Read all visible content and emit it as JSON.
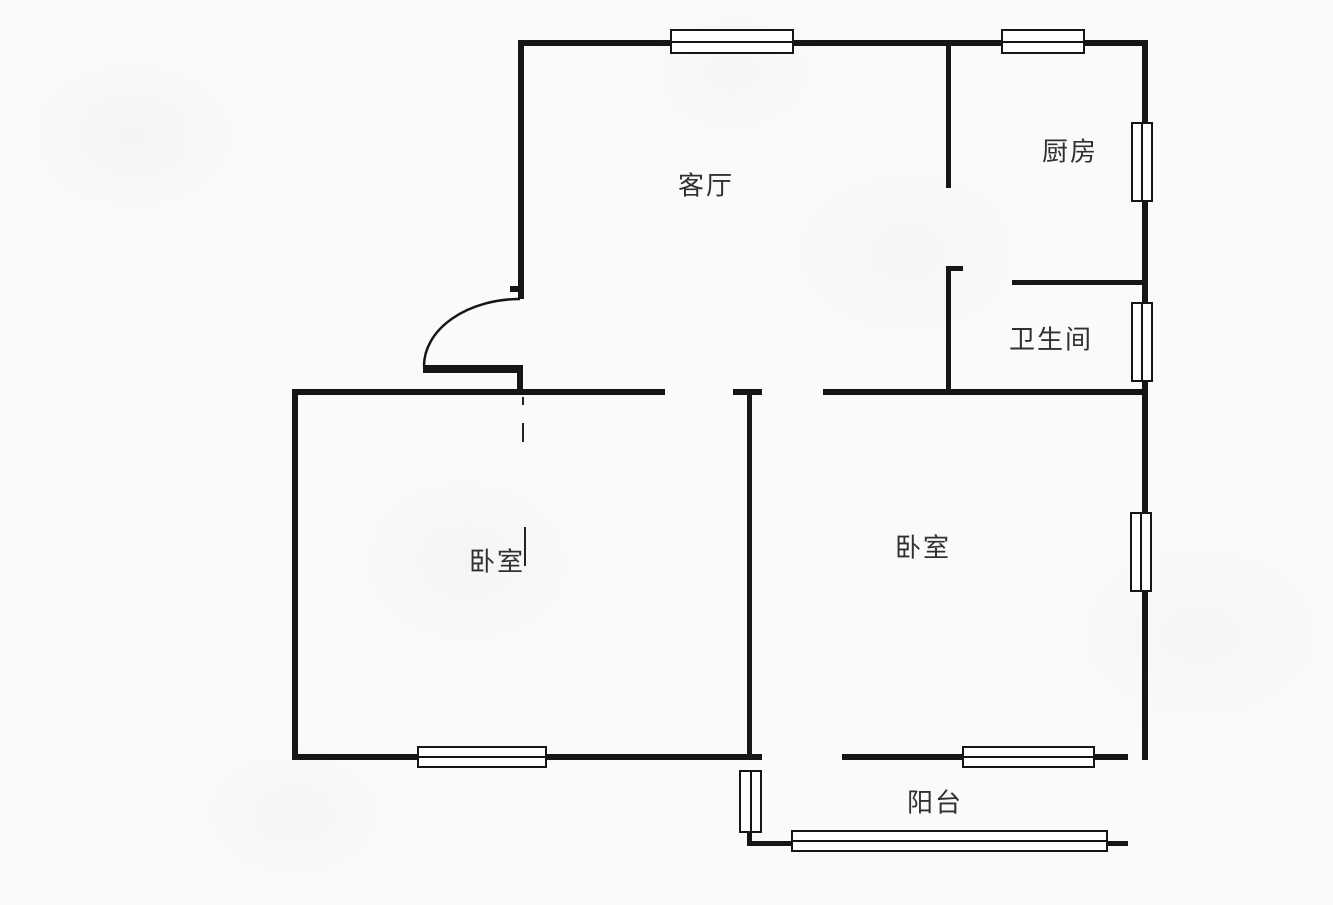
{
  "plan": {
    "colors": {
      "background": "#fbfafa",
      "line": "#161616",
      "text": "#303030"
    },
    "rooms": [
      {
        "label": "客厅",
        "x": 706,
        "y": 184
      },
      {
        "label": "厨房",
        "x": 1070,
        "y": 150
      },
      {
        "label": "卫生间",
        "x": 1051,
        "y": 338
      },
      {
        "label": "卧室",
        "x": 497,
        "y": 560
      },
      {
        "label": "卧室",
        "x": 923,
        "y": 546
      },
      {
        "label": "阳台",
        "x": 935,
        "y": 801
      }
    ],
    "walls": [
      {
        "x": 518,
        "y": 40,
        "w": 153,
        "h": 6
      },
      {
        "x": 793,
        "y": 40,
        "w": 209,
        "h": 6
      },
      {
        "x": 1084,
        "y": 40,
        "w": 64,
        "h": 6
      },
      {
        "x": 518,
        "y": 40,
        "w": 6,
        "h": 259
      },
      {
        "x": 510,
        "y": 286,
        "w": 9,
        "h": 6
      },
      {
        "x": 1142,
        "y": 40,
        "w": 6,
        "h": 84
      },
      {
        "x": 1142,
        "y": 200,
        "w": 6,
        "h": 104
      },
      {
        "x": 1142,
        "y": 380,
        "w": 6,
        "h": 134
      },
      {
        "x": 1142,
        "y": 590,
        "w": 6,
        "h": 170
      },
      {
        "x": 946,
        "y": 43,
        "w": 5,
        "h": 145
      },
      {
        "x": 946,
        "y": 266,
        "w": 5,
        "h": 126
      },
      {
        "x": 946,
        "y": 266,
        "w": 17,
        "h": 5
      },
      {
        "x": 1012,
        "y": 280,
        "w": 133,
        "h": 5
      },
      {
        "x": 292,
        "y": 389,
        "w": 373,
        "h": 6
      },
      {
        "x": 733,
        "y": 389,
        "w": 29,
        "h": 6
      },
      {
        "x": 823,
        "y": 389,
        "w": 322,
        "h": 6
      },
      {
        "x": 423,
        "y": 365,
        "w": 96,
        "h": 8
      },
      {
        "x": 517,
        "y": 365,
        "w": 6,
        "h": 28
      },
      {
        "x": 292,
        "y": 389,
        "w": 6,
        "h": 371
      },
      {
        "x": 292,
        "y": 754,
        "w": 126,
        "h": 6
      },
      {
        "x": 546,
        "y": 754,
        "w": 216,
        "h": 6
      },
      {
        "x": 747,
        "y": 392,
        "w": 5,
        "h": 366
      },
      {
        "x": 842,
        "y": 754,
        "w": 121,
        "h": 6
      },
      {
        "x": 1094,
        "y": 754,
        "w": 34,
        "h": 6
      },
      {
        "x": 747,
        "y": 829,
        "w": 5,
        "h": 16
      },
      {
        "x": 747,
        "y": 841,
        "w": 45,
        "h": 5
      },
      {
        "x": 1107,
        "y": 841,
        "w": 21,
        "h": 5
      }
    ],
    "windows": [
      {
        "x": 670,
        "y": 29,
        "w": 124,
        "h": 25,
        "o": "h"
      },
      {
        "x": 1001,
        "y": 29,
        "w": 84,
        "h": 25,
        "o": "h"
      },
      {
        "x": 1131,
        "y": 122,
        "w": 22,
        "h": 80,
        "o": "v"
      },
      {
        "x": 1131,
        "y": 302,
        "w": 22,
        "h": 80,
        "o": "v"
      },
      {
        "x": 1130,
        "y": 512,
        "w": 22,
        "h": 80,
        "o": "v"
      },
      {
        "x": 417,
        "y": 746,
        "w": 130,
        "h": 22,
        "o": "h"
      },
      {
        "x": 962,
        "y": 746,
        "w": 133,
        "h": 22,
        "o": "h"
      },
      {
        "x": 791,
        "y": 830,
        "w": 317,
        "h": 22,
        "o": "h"
      },
      {
        "x": 739,
        "y": 770,
        "w": 23,
        "h": 63,
        "o": "v"
      }
    ],
    "dashes": [
      {
        "x": 522,
        "y": 397,
        "w": 2,
        "h": 8
      },
      {
        "x": 522,
        "y": 423,
        "w": 2,
        "h": 19
      },
      {
        "x": 524,
        "y": 527,
        "w": 2,
        "h": 39
      }
    ],
    "door_arc": "M 520 299 A 96 67 0 0 0 424 366"
  }
}
